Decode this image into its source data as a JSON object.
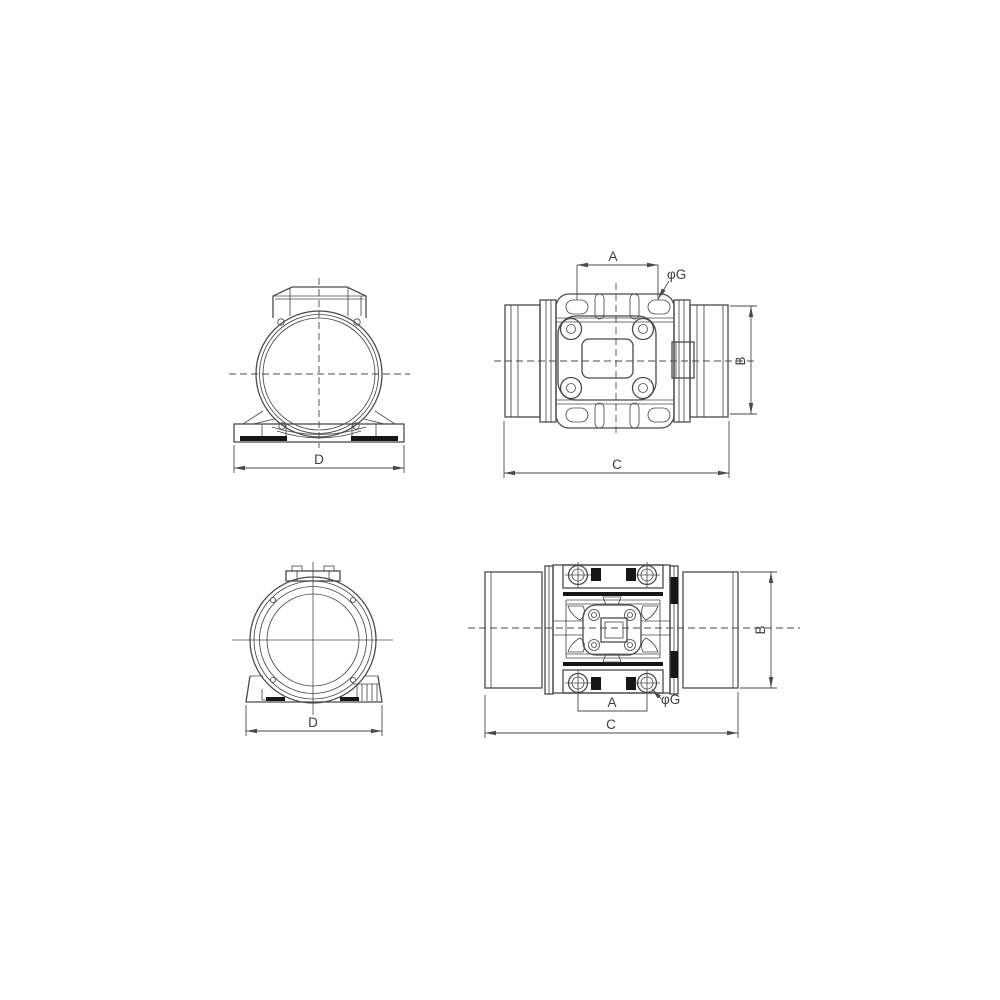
{
  "colors": {
    "background": "#ffffff",
    "line": "#4a4a4a",
    "solid_black": "#161616",
    "text": "#3d3d3d"
  },
  "views": {
    "front": {
      "dims": {
        "d": "D"
      }
    },
    "top": {
      "dims": {
        "a": "A",
        "phi_g": "φG",
        "b": "B",
        "c": "C"
      }
    },
    "end": {
      "dims": {
        "d": "D"
      }
    },
    "bottom": {
      "dims": {
        "a": "A",
        "phi_g": "φG",
        "b": "B",
        "c": "C"
      }
    }
  }
}
